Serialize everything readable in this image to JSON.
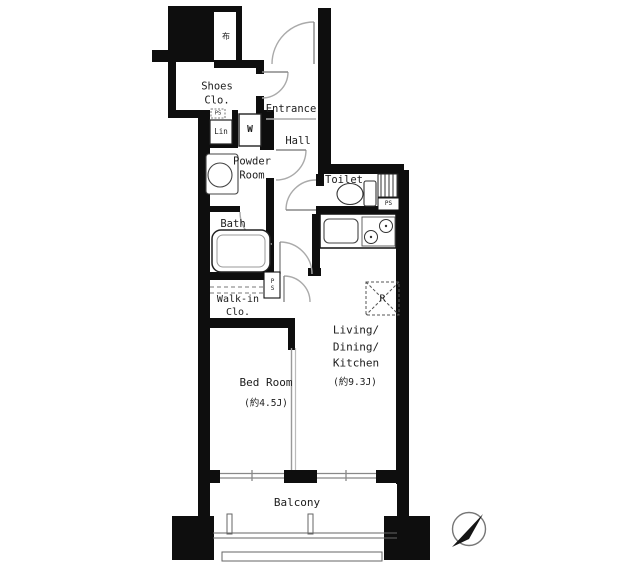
{
  "title": "apartment-floor-plan",
  "rooms": {
    "storage_niche": "布",
    "shoes_closet": "Shoes\nClo.",
    "entrance": "Entrance",
    "hall": "Hall",
    "powder_room": "Powder\nRoom",
    "toilet": "Toilet",
    "bath": "Bath",
    "walk_in_closet": "Walk-in\nClo.",
    "bedroom": {
      "label": "Bed Room",
      "size": "(約4.5J)"
    },
    "ldk": {
      "label": "Living/\nDining/\nKitchen",
      "size": "(約9.3J)"
    },
    "balcony": "Balcony"
  },
  "fixtures": {
    "washer": "W",
    "linen": "Lin",
    "refrigerator": "R",
    "ps_entry": "PS",
    "ps_toilet": "PS",
    "ps_hall": "PS"
  },
  "colors": {
    "wall": "#0e0e0e",
    "door_arc": "#aaaaaa",
    "thin_line": "#666666"
  }
}
